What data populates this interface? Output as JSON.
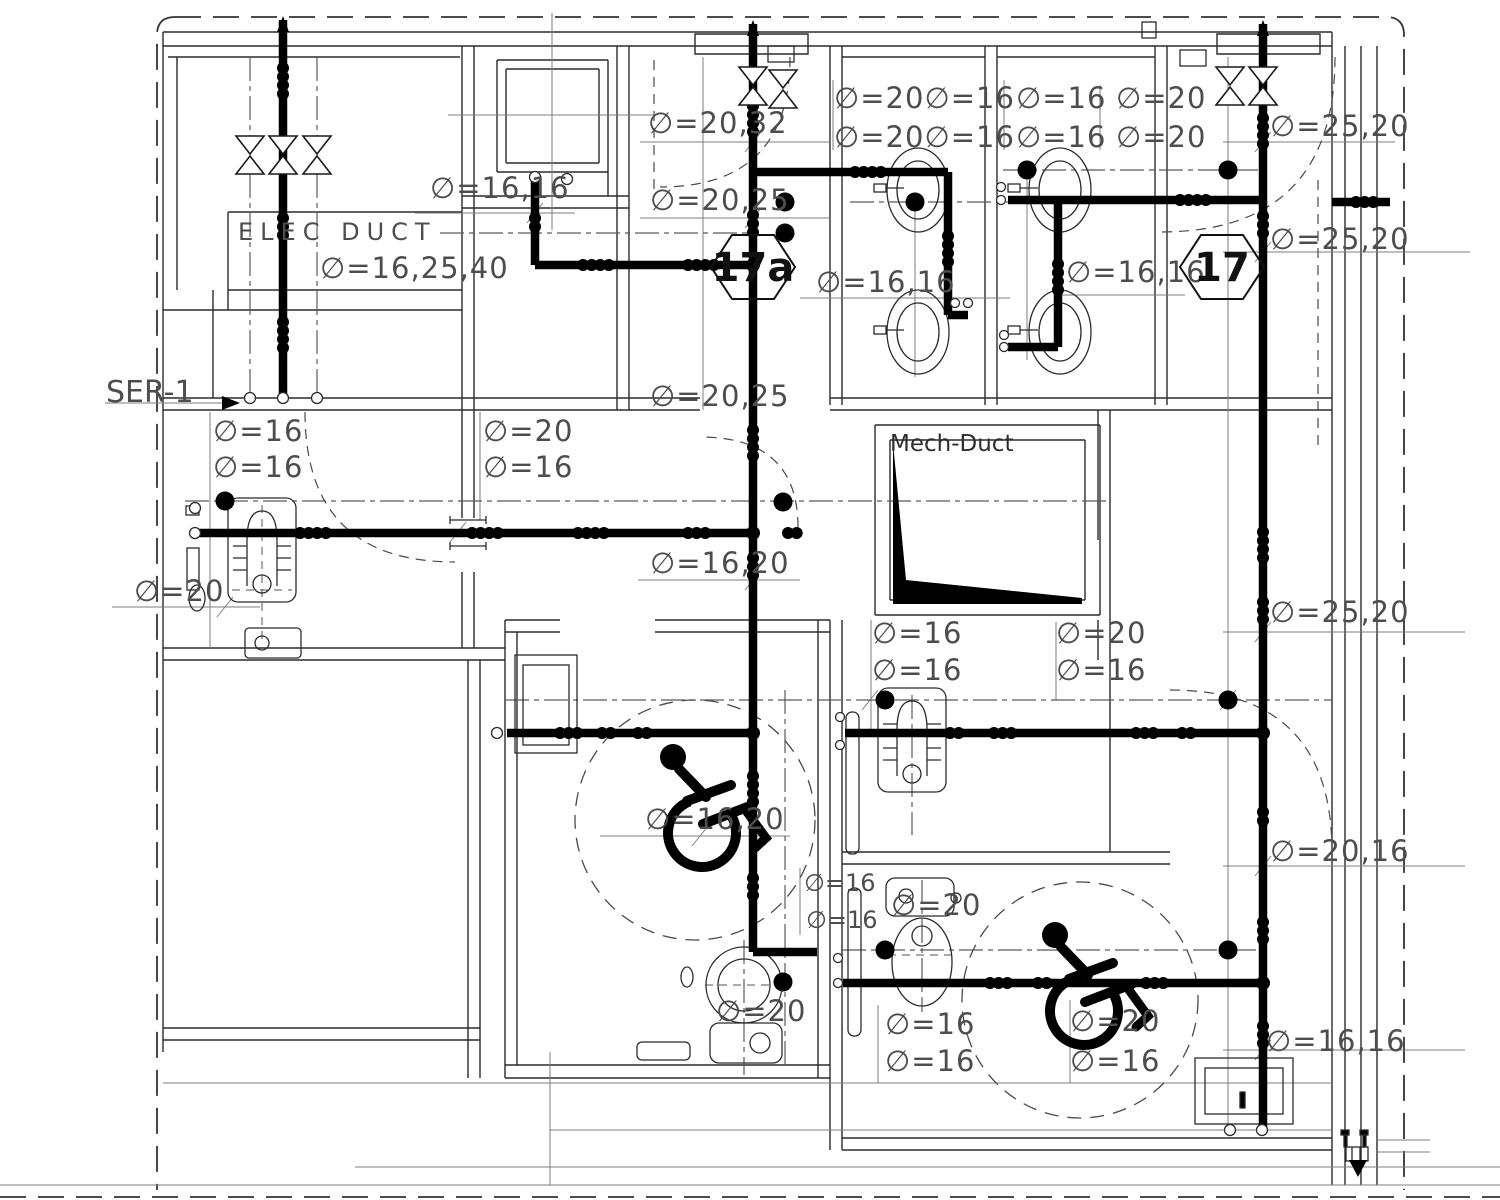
{
  "drawing": {
    "type": "sanitary-piping-floor-plan",
    "background": "#ffffff",
    "line_color": "#2b2b2b",
    "pipe_color": "#000000",
    "label_color": "#4d4d4d"
  },
  "tags": [
    {
      "text": "17a",
      "x": 753,
      "y": 281
    },
    {
      "text": "17",
      "x": 1222,
      "y": 281
    }
  ],
  "labels": [
    {
      "text": "ELEC DUCT",
      "x": 238,
      "y": 240,
      "cls": "room"
    },
    {
      "text": "∅=16,25,40",
      "x": 320,
      "y": 278,
      "cls": "dim"
    },
    {
      "text": "∅=16,16",
      "x": 430,
      "y": 198,
      "cls": "dim"
    },
    {
      "text": "∅=20,32",
      "x": 648,
      "y": 133,
      "cls": "dim"
    },
    {
      "text": "∅=20,25",
      "x": 650,
      "y": 210,
      "cls": "dim"
    },
    {
      "text": "∅=20∅=16",
      "x": 834,
      "y": 108,
      "cls": "dim"
    },
    {
      "text": "∅=20∅=16",
      "x": 834,
      "y": 147,
      "cls": "dim"
    },
    {
      "text": "∅=16",
      "x": 1016,
      "y": 108,
      "cls": "dim"
    },
    {
      "text": "∅=16",
      "x": 1016,
      "y": 147,
      "cls": "dim"
    },
    {
      "text": "∅=20",
      "x": 1116,
      "y": 108,
      "cls": "dim"
    },
    {
      "text": "∅=20",
      "x": 1116,
      "y": 147,
      "cls": "dim"
    },
    {
      "text": "∅=25,20",
      "x": 1270,
      "y": 136,
      "cls": "dim"
    },
    {
      "text": "∅=25,20",
      "x": 1270,
      "y": 249,
      "cls": "dim"
    },
    {
      "text": "∅=16,16",
      "x": 816,
      "y": 292,
      "cls": "dim"
    },
    {
      "text": "∅=16,16",
      "x": 1066,
      "y": 282,
      "cls": "dim"
    },
    {
      "text": "SER-1",
      "x": 106,
      "y": 402,
      "cls": "ser"
    },
    {
      "text": "∅=20,25",
      "x": 650,
      "y": 406,
      "cls": "dim"
    },
    {
      "text": "∅=16",
      "x": 213,
      "y": 441,
      "cls": "dim"
    },
    {
      "text": "∅=16",
      "x": 213,
      "y": 477,
      "cls": "dim"
    },
    {
      "text": "∅=20",
      "x": 483,
      "y": 441,
      "cls": "dim"
    },
    {
      "text": "∅=16",
      "x": 483,
      "y": 477,
      "cls": "dim"
    },
    {
      "text": "Mech-Duct",
      "x": 890,
      "y": 451,
      "cls": "room2"
    },
    {
      "text": "∅=16,20",
      "x": 650,
      "y": 573,
      "cls": "dim"
    },
    {
      "text": "∅=20",
      "x": 134,
      "y": 601,
      "cls": "dim"
    },
    {
      "text": "∅=25,20",
      "x": 1270,
      "y": 622,
      "cls": "dim"
    },
    {
      "text": "∅=16",
      "x": 872,
      "y": 643,
      "cls": "dim"
    },
    {
      "text": "∅=16",
      "x": 872,
      "y": 680,
      "cls": "dim"
    },
    {
      "text": "∅=20",
      "x": 1056,
      "y": 643,
      "cls": "dim"
    },
    {
      "text": "∅=16",
      "x": 1056,
      "y": 680,
      "cls": "dim"
    },
    {
      "text": "∅=16,20",
      "x": 645,
      "y": 829,
      "cls": "dim"
    },
    {
      "text": "∅=16",
      "x": 804,
      "y": 891,
      "cls": "dimS"
    },
    {
      "text": "∅=16",
      "x": 806,
      "y": 928,
      "cls": "dimS"
    },
    {
      "text": "∅=20",
      "x": 891,
      "y": 915,
      "cls": "dim"
    },
    {
      "text": "∅=20,16",
      "x": 1270,
      "y": 861,
      "cls": "dim"
    },
    {
      "text": "∅=20",
      "x": 716,
      "y": 1021,
      "cls": "dim"
    },
    {
      "text": "∅=16",
      "x": 885,
      "y": 1034,
      "cls": "dim"
    },
    {
      "text": "∅=16",
      "x": 885,
      "y": 1071,
      "cls": "dim"
    },
    {
      "text": "∅=20",
      "x": 1070,
      "y": 1031,
      "cls": "dim"
    },
    {
      "text": "∅=16",
      "x": 1070,
      "y": 1071,
      "cls": "dim"
    },
    {
      "text": "∅=16,16",
      "x": 1266,
      "y": 1051,
      "cls": "dim"
    }
  ]
}
